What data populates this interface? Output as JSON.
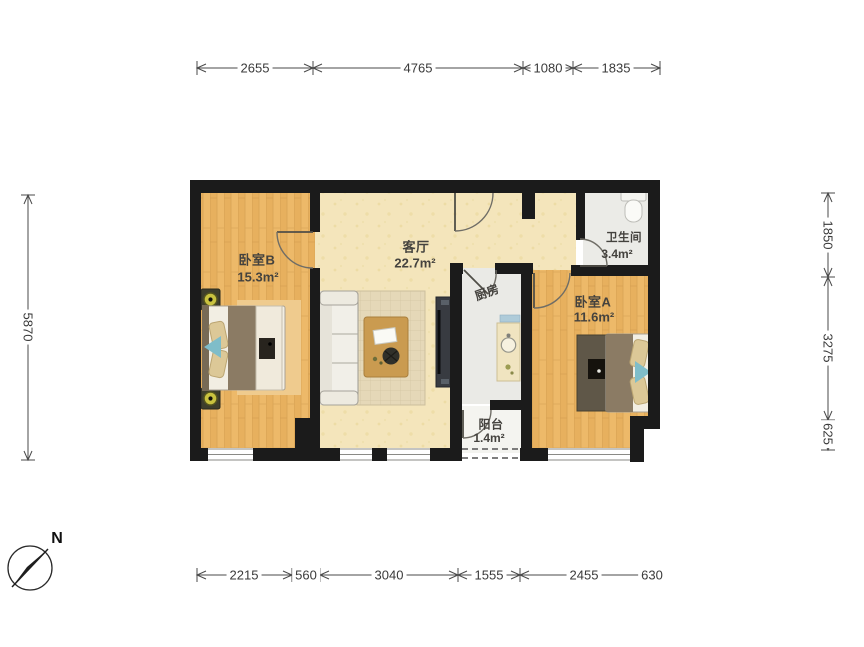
{
  "compass": {
    "label": "N"
  },
  "rooms": [
    {
      "name": "卧室B",
      "area": "15.3m²"
    },
    {
      "name": "客厅",
      "area": "22.7m²"
    },
    {
      "name": "厨房"
    },
    {
      "name": "卫生间",
      "area": "3.4m²"
    },
    {
      "name": "卧室A",
      "area": "11.6m²"
    },
    {
      "name": "阳台",
      "area": "1.4m²"
    }
  ],
  "dimensions_mm": {
    "top": [
      "2655",
      "4765",
      "1080",
      "1835"
    ],
    "bottom": [
      "2215",
      "560",
      "3040",
      "1555",
      "2455",
      "630"
    ],
    "left": [
      "5870"
    ],
    "right": [
      "1850",
      "3275",
      "625"
    ]
  },
  "colors": {
    "wall": "#1b1b1b",
    "wood_floor": "#ecb768",
    "living_floor": "#f4e5bb",
    "wet_floor": "#eaeae6",
    "accent_blue": "#7fbdc9"
  }
}
